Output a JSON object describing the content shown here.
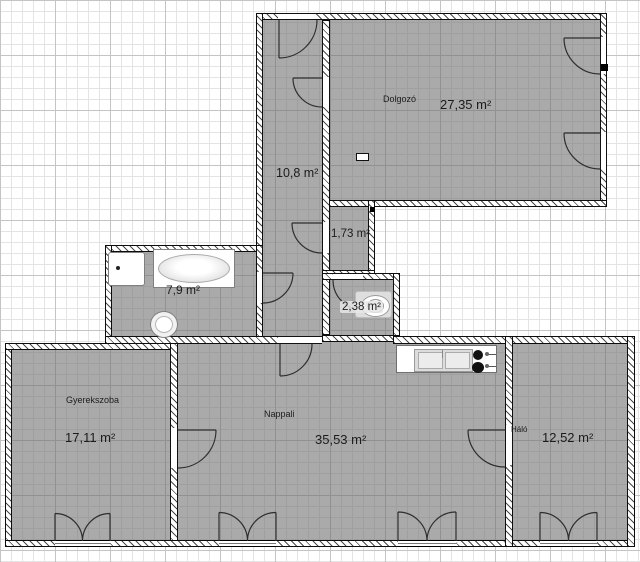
{
  "plan": {
    "title": "apartment-floor-plan",
    "rooms": [
      {
        "id": "dolgozo",
        "name": "Dolgozó",
        "area": "27,35 m²"
      },
      {
        "id": "hallway",
        "name": "",
        "area": "10,8 m²"
      },
      {
        "id": "wc",
        "name": "",
        "area": "1,73 m²"
      },
      {
        "id": "toilet-room",
        "name": "",
        "area": "2,38 m²"
      },
      {
        "id": "bathroom",
        "name": "",
        "area": "7,9 m²"
      },
      {
        "id": "gyerekszoba",
        "name": "Gyerekszoba",
        "area": "17,11 m²"
      },
      {
        "id": "nappali",
        "name": "Nappali",
        "area": "35,53 m²"
      },
      {
        "id": "halo",
        "name": "Háló",
        "area": "12,52 m²"
      }
    ],
    "fixtures": [
      "bathtub",
      "shower-tray",
      "washbasin",
      "toilet",
      "kitchen-sink",
      "cooktop",
      "radiator"
    ],
    "colors": {
      "room_fill": "#a6a6a6",
      "wall_outline": "#0d0d0d",
      "grid_minor": "#e4e4e4",
      "grid_major": "#c4c4c4",
      "background": "#ffffff"
    }
  }
}
